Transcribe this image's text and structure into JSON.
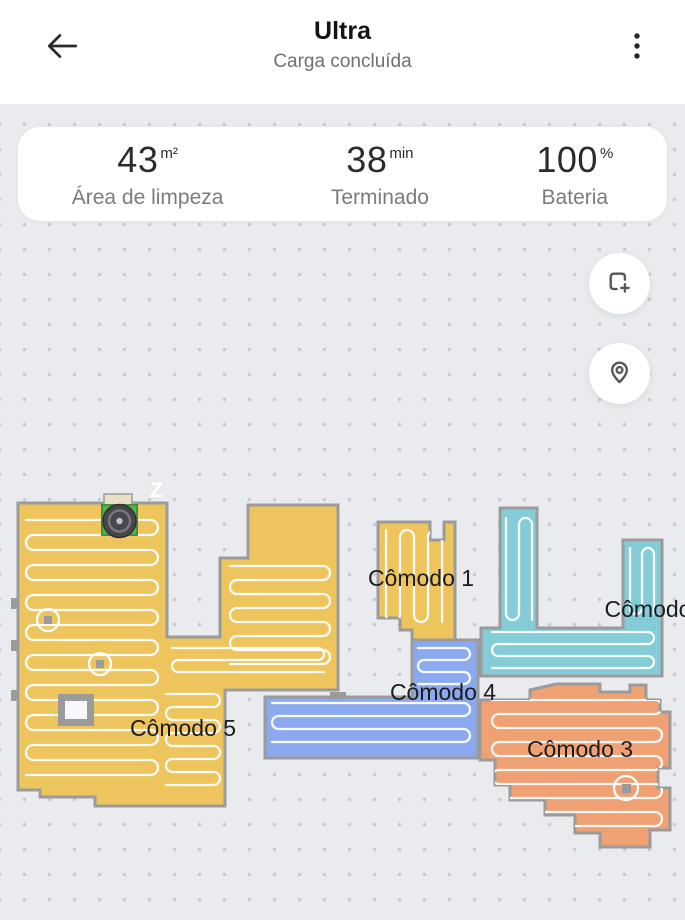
{
  "header": {
    "title": "Ultra",
    "subtitle": "Carga concluída"
  },
  "stats": [
    {
      "value": "43",
      "unit": "m²",
      "label": "Área de limpeza"
    },
    {
      "value": "38",
      "unit": "min",
      "label": "Terminado"
    },
    {
      "value": "100",
      "unit": "%",
      "label": "Bateria"
    }
  ],
  "map": {
    "north_marker": "Z",
    "wall_color": "#9b9b9b",
    "path_color": "#ffffff",
    "background_color": "#e9ebef",
    "rooms": [
      {
        "name": "Cômodo 1",
        "color": "#eec45d"
      },
      {
        "name": "Cômodo",
        "color": "#84cdd8"
      },
      {
        "name": "Cômodo 3",
        "color": "#f0a173"
      },
      {
        "name": "Cômodo 4",
        "color": "#8aa9ee"
      },
      {
        "name": "Cômodo 5",
        "color": "#eec45d"
      }
    ],
    "dock_color": "#56b44a"
  }
}
